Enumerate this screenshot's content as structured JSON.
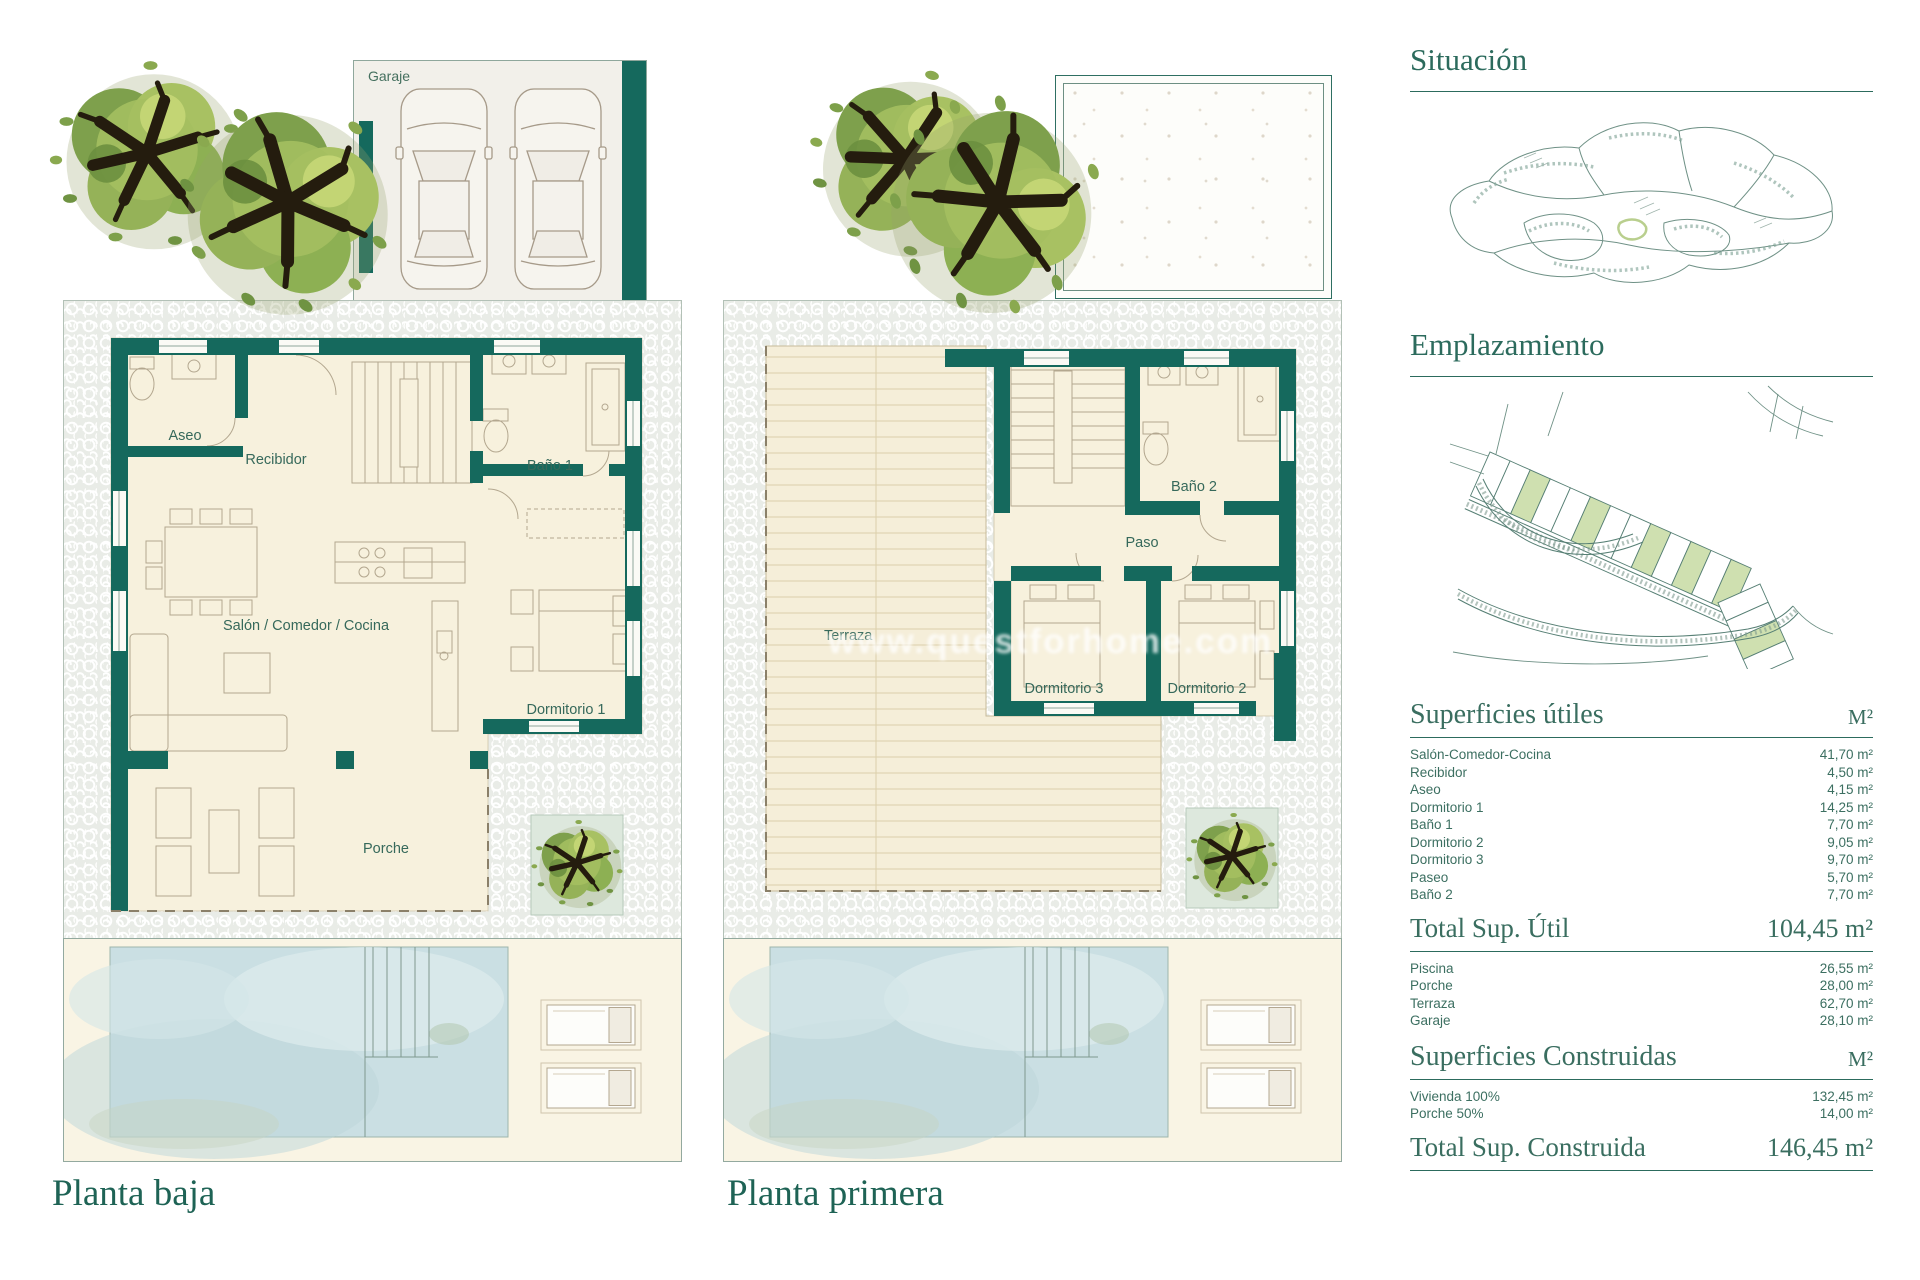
{
  "colors": {
    "wall_teal": "#15695d",
    "accent_text": "#2c6b5d",
    "cream_floor": "#f7f1dd",
    "pool_blue": "#cadfe3",
    "parcel_green": "#cfe0b0"
  },
  "left_plan": {
    "caption": "Planta baja",
    "garage_label": "Garaje",
    "rooms": {
      "aseo": "Aseo",
      "recibidor": "Recibidor",
      "bano1": "Baño 1",
      "salon": "Salón / Comedor / Cocina",
      "dormitorio1": "Dormitorio 1",
      "porche": "Porche"
    }
  },
  "right_plan": {
    "caption": "Planta primera",
    "watermark": "www.questforhome.com",
    "rooms": {
      "terraza": "Terraza",
      "bano2": "Baño 2",
      "paso": "Paso",
      "dormitorio3": "Dormitorio 3",
      "dormitorio2": "Dormitorio 2"
    }
  },
  "panel": {
    "situacion_title": "Situación",
    "emplazamiento_title": "Emplazamiento",
    "util": {
      "title": "Superficies útiles",
      "unit": "M²",
      "rows": [
        {
          "label": "Salón-Comedor-Cocina",
          "value": "41,70 m²"
        },
        {
          "label": "Recibidor",
          "value": "4,50 m²"
        },
        {
          "label": "Aseo",
          "value": "4,15 m²"
        },
        {
          "label": "Dormitorio 1",
          "value": "14,25 m²"
        },
        {
          "label": "Baño 1",
          "value": "7,70 m²"
        },
        {
          "label": "Dormitorio 2",
          "value": "9,05 m²"
        },
        {
          "label": "Dormitorio 3",
          "value": "9,70 m²"
        },
        {
          "label": "Paseo",
          "value": "5,70 m²"
        },
        {
          "label": "Baño 2",
          "value": "7,70 m²"
        }
      ]
    },
    "total_util": {
      "label": "Total Sup. Útil",
      "value": "104,45 m²"
    },
    "outdoor_rows": [
      {
        "label": "Piscina",
        "value": "26,55 m²"
      },
      {
        "label": "Porche",
        "value": "28,00 m²"
      },
      {
        "label": "Terraza",
        "value": "62,70 m²"
      },
      {
        "label": "Garaje",
        "value": "28,10 m²"
      }
    ],
    "construidas": {
      "title": "Superficies Construidas",
      "unit": "M²",
      "rows": [
        {
          "label": "Vivienda 100%",
          "value": "132,45 m²"
        },
        {
          "label": "Porche 50%",
          "value": "14,00 m²"
        }
      ]
    },
    "total_construida": {
      "label": "Total Sup. Construida",
      "value": "146,45 m²"
    }
  }
}
